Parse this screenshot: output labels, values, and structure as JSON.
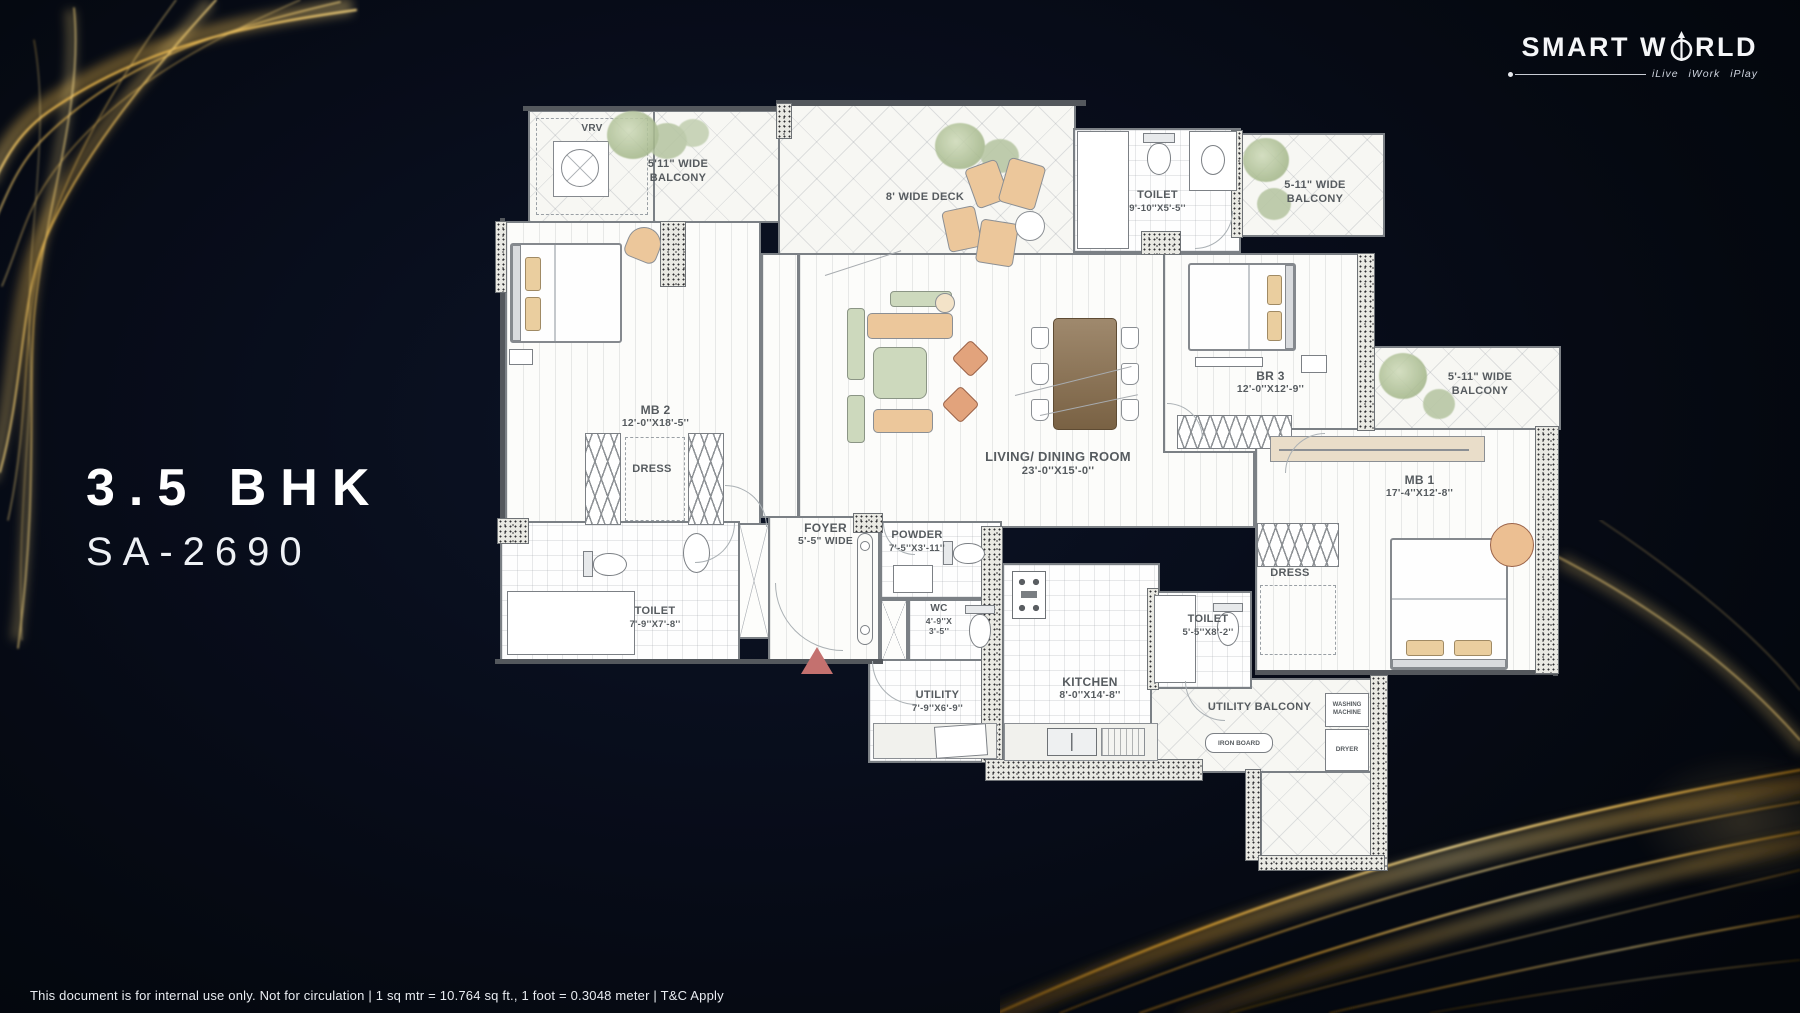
{
  "brand": {
    "name_left": "SMART W",
    "name_right": "RLD",
    "tagline": "iLive iWork iPlay"
  },
  "unit": {
    "type": "3.5 BHK",
    "code": "SA-2690"
  },
  "plan": {
    "vrv": {
      "name": "VRV"
    },
    "balcony_tl": {
      "name": "5'11\" WIDE",
      "name2": "BALCONY"
    },
    "deck": {
      "name": "8' WIDE DECK"
    },
    "toilet_top": {
      "name": "TOILET",
      "dims": "9'-10''X5'-5''"
    },
    "balcony_tr": {
      "name": "5-11\" WIDE",
      "name2": "BALCONY"
    },
    "mb2": {
      "name": "MB 2",
      "dims": "12'-0''X18'-5''"
    },
    "dress_mb2": {
      "name": "DRESS"
    },
    "living": {
      "name": "LIVING/ DINING ROOM",
      "dims": "23'-0''X15'-0''"
    },
    "br3": {
      "name": "BR 3",
      "dims": "12'-0''X12'-9''"
    },
    "balcony_r": {
      "name": "5'-11\" WIDE",
      "name2": "BALCONY"
    },
    "mb1": {
      "name": "MB 1",
      "dims": "17'-4''X12'-8''"
    },
    "dress_mb1": {
      "name": "DRESS"
    },
    "toilet_bl": {
      "name": "TOILET",
      "dims": "7'-9''X7'-8''"
    },
    "foyer": {
      "name": "FOYER",
      "dims": "5'-5\" WIDE"
    },
    "powder": {
      "name": "POWDER",
      "dims": "7'-5''X3'-11''"
    },
    "wc": {
      "name": "WC",
      "dims1": "4'-9''X",
      "dims2": "3'-5''"
    },
    "kitchen": {
      "name": "KITCHEN",
      "dims": "8'-0''X14'-8''"
    },
    "utility": {
      "name": "UTILITY",
      "dims": "7'-9''X6'-9''"
    },
    "toilet_k": {
      "name": "TOILET",
      "dims": "5'-5''X8'-2''"
    },
    "utility_balcony": {
      "name": "UTILITY BALCONY"
    },
    "washing_machine": {
      "line1": "WASHING",
      "line2": "MACHINE"
    },
    "dryer": {
      "name": "DRYER"
    },
    "iron_board": {
      "name": "IRON BOARD"
    }
  },
  "footer": {
    "disclaimer": "This document is for internal use only. Not for circulation | 1 sq mtr = 10.764 sq ft., 1 foot = 0.3048 meter | T&C Apply"
  },
  "colors": {
    "background": "#05080f",
    "gold": "#d9a43b",
    "entry_arrow": "#c4716f"
  }
}
